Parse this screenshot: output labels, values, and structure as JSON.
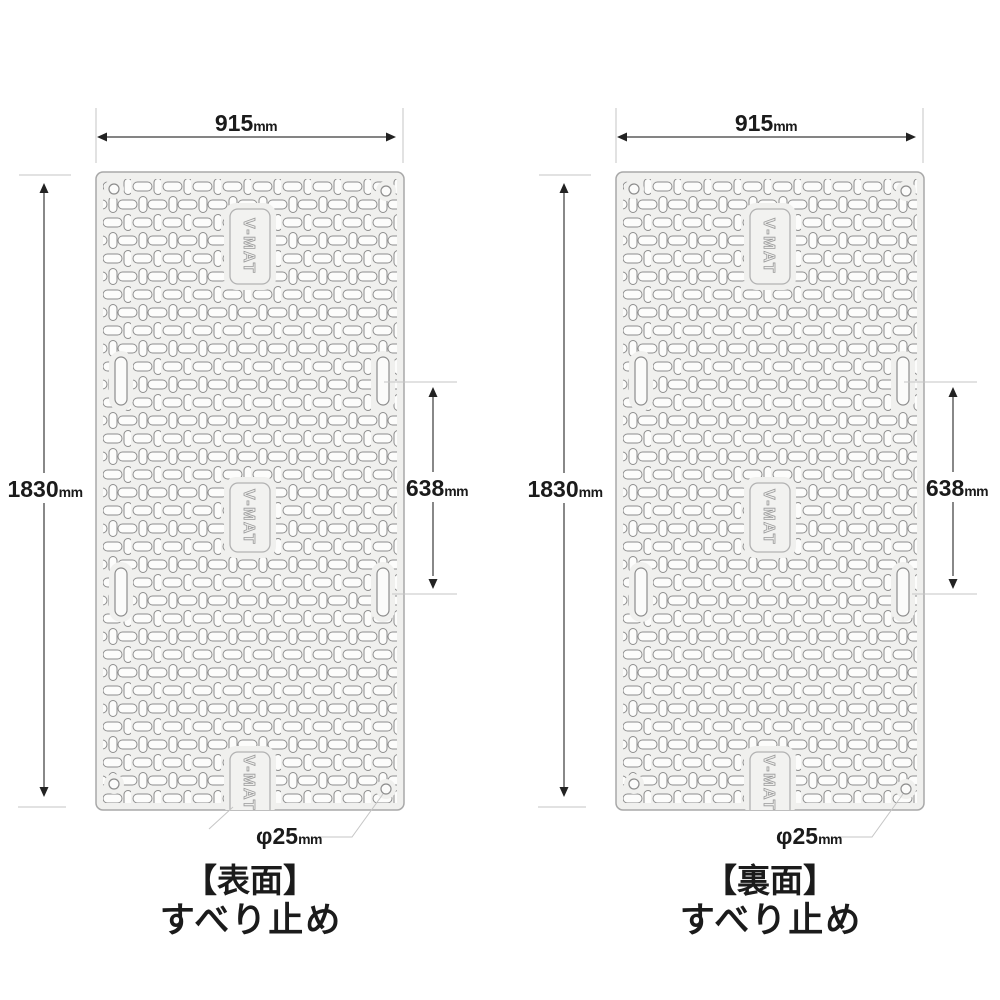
{
  "diagram": {
    "brand": "V-MAT",
    "dimensions": {
      "width_value": "915",
      "height_value": "1830",
      "slot_spacing_value": "638",
      "hole_diameter_value": "φ25",
      "unit": "mm"
    },
    "panels": [
      {
        "id": "front",
        "title": "【表面】",
        "subtitle": "すべり止め"
      },
      {
        "id": "back",
        "title": "【裏面】",
        "subtitle": "すべり止め"
      }
    ],
    "colors": {
      "background": "#ffffff",
      "mat_fill": "#f0f0ee",
      "mat_stroke": "#a8a8a8",
      "perforation_stroke": "#8d8d8d",
      "dimension_line": "#3a3a3a",
      "extension_line": "#c6c6c6",
      "text": "#1b1b1b"
    }
  }
}
